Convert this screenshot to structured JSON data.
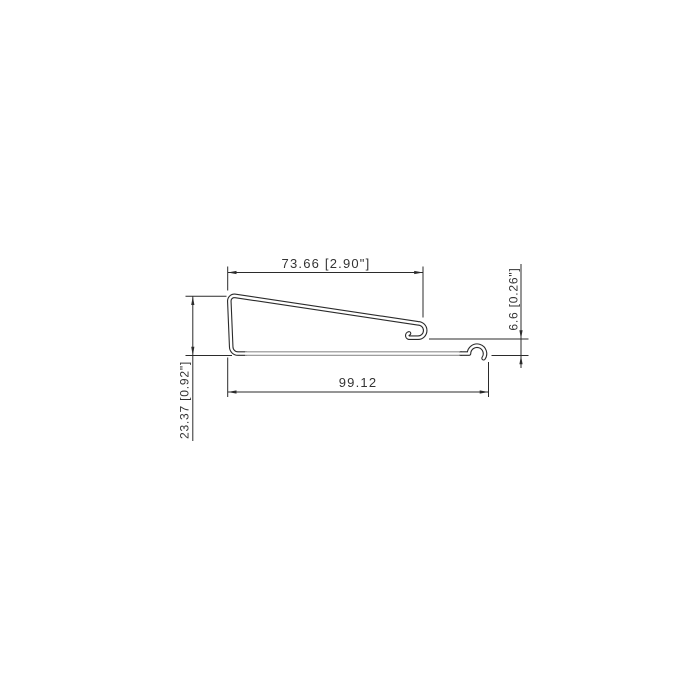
{
  "drawing": {
    "type": "technical-profile-cross-section",
    "background_color": "#ffffff",
    "outline_color": "#2b2b2b",
    "sheet_gray_color": "#8f8f8f",
    "text_color": "#333333",
    "dimensions": {
      "top_width_label": "73.66 [2.90\"]",
      "bottom_width_label": "99.12",
      "left_height_label": "23.37 [0.92\"]",
      "right_height_label": "6.6 [0.26\"]"
    },
    "values_mm": {
      "top_width": 73.66,
      "bottom_width": 99.12,
      "left_height": 23.37,
      "right_height": 6.6
    },
    "values_inch": {
      "top_width": 2.9,
      "left_height": 0.92,
      "right_height": 0.26
    }
  }
}
